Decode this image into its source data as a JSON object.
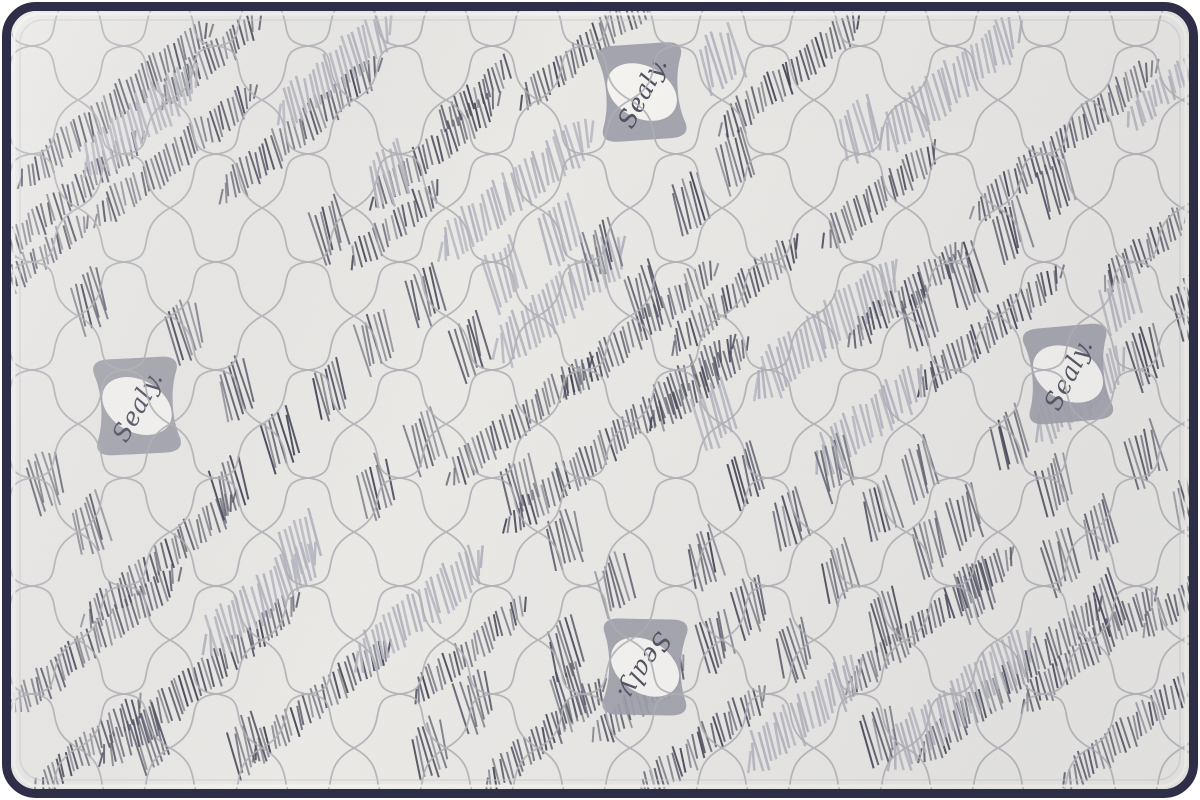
{
  "meta": {
    "description": "Top-down product photo of a quilted Sealy mattress with navy piped edge",
    "brand": "Sealy",
    "badge_label": "Sealy."
  },
  "colors": {
    "page_bg": "#ffffff",
    "fabric": "#ebeae7",
    "fabric_shade": "#8c8c96",
    "quilt_line": "#aeaeb4",
    "hatch_dark": [
      "#3f4052",
      "#4a4b5c",
      "#585a6a"
    ],
    "hatch_light": "#b5b6c1",
    "border": "#2e2e48",
    "piping_highlight": "#f4f4f1",
    "seam_shadow": "#c9c9cd",
    "badge_fill": "#9d9da9",
    "badge_oval": "#f6f5f2",
    "badge_text": "#4e4e5e"
  },
  "geometry": {
    "canvas_w": 1200,
    "canvas_h": 800,
    "border_width": 9,
    "corner_radius": 34,
    "band_angle_deg": -39,
    "lattice_tile_w": 92,
    "lattice_tile_h": 108
  },
  "badges": [
    {
      "x": 642,
      "y": 92,
      "rot": -4
    },
    {
      "x": 137,
      "y": 406,
      "rot": -3
    },
    {
      "x": 1068,
      "y": 374,
      "rot": -5
    },
    {
      "x": 645,
      "y": 667,
      "rot": 181
    }
  ],
  "bands": [
    [
      115,
      105,
      250,
      26,
      0
    ],
    [
      70,
      195,
      190,
      24,
      0
    ],
    [
      175,
      155,
      210,
      26,
      0
    ],
    [
      30,
      265,
      150,
      22,
      0
    ],
    [
      210,
      60,
      130,
      24,
      0
    ],
    [
      300,
      130,
      210,
      28,
      0
    ],
    [
      140,
      120,
      150,
      38,
      1
    ],
    [
      335,
      70,
      150,
      36,
      1
    ],
    [
      435,
      150,
      170,
      26,
      0
    ],
    [
      395,
      225,
      120,
      24,
      0
    ],
    [
      515,
      190,
      200,
      36,
      1
    ],
    [
      585,
      50,
      170,
      26,
      0
    ],
    [
      475,
      95,
      90,
      22,
      0
    ],
    [
      790,
      75,
      180,
      26,
      0
    ],
    [
      950,
      85,
      180,
      38,
      1
    ],
    [
      1065,
      140,
      240,
      26,
      0
    ],
    [
      880,
      195,
      150,
      26,
      0
    ],
    [
      1165,
      90,
      100,
      24,
      1
    ],
    [
      1145,
      250,
      110,
      24,
      0
    ],
    [
      640,
      330,
      200,
      26,
      0
    ],
    [
      560,
      300,
      170,
      40,
      1
    ],
    [
      735,
      295,
      170,
      26,
      0
    ],
    [
      825,
      330,
      190,
      40,
      1
    ],
    [
      905,
      295,
      150,
      24,
      0
    ],
    [
      990,
      330,
      190,
      26,
      0
    ],
    [
      520,
      420,
      190,
      26,
      0
    ],
    [
      620,
      435,
      300,
      28,
      0
    ],
    [
      700,
      385,
      130,
      24,
      0
    ],
    [
      870,
      420,
      140,
      36,
      1
    ],
    [
      1080,
      395,
      120,
      36,
      1
    ],
    [
      95,
      640,
      220,
      26,
      0
    ],
    [
      200,
      680,
      260,
      28,
      0
    ],
    [
      160,
      560,
      200,
      26,
      0
    ],
    [
      260,
      600,
      150,
      36,
      1
    ],
    [
      320,
      700,
      180,
      26,
      0
    ],
    [
      90,
      745,
      140,
      24,
      0
    ],
    [
      420,
      610,
      170,
      36,
      1
    ],
    [
      470,
      650,
      150,
      24,
      0
    ],
    [
      545,
      735,
      160,
      26,
      0
    ],
    [
      930,
      620,
      220,
      26,
      0
    ],
    [
      1010,
      680,
      240,
      28,
      0
    ],
    [
      960,
      700,
      190,
      40,
      1
    ],
    [
      1090,
      650,
      180,
      26,
      0
    ],
    [
      1130,
      730,
      170,
      26,
      0
    ],
    [
      1180,
      600,
      100,
      24,
      0
    ],
    [
      700,
      745,
      170,
      26,
      0
    ],
    [
      640,
      700,
      120,
      24,
      0
    ],
    [
      805,
      715,
      150,
      36,
      1
    ],
    [
      90,
      300,
      38,
      44,
      0
    ],
    [
      185,
      330,
      38,
      44,
      0
    ],
    [
      235,
      390,
      38,
      44,
      0
    ],
    [
      330,
      230,
      38,
      44,
      0
    ],
    [
      425,
      295,
      38,
      44,
      0
    ],
    [
      375,
      340,
      38,
      44,
      0
    ],
    [
      470,
      345,
      38,
      44,
      0
    ],
    [
      280,
      440,
      38,
      44,
      0
    ],
    [
      230,
      488,
      38,
      44,
      0
    ],
    [
      330,
      390,
      38,
      44,
      0
    ],
    [
      425,
      440,
      38,
      44,
      0
    ],
    [
      520,
      485,
      38,
      44,
      0
    ],
    [
      565,
      540,
      38,
      44,
      0
    ],
    [
      375,
      488,
      38,
      44,
      0
    ],
    [
      615,
      585,
      38,
      44,
      0
    ],
    [
      715,
      640,
      38,
      44,
      0
    ],
    [
      705,
      560,
      38,
      44,
      0
    ],
    [
      750,
      605,
      38,
      44,
      0
    ],
    [
      795,
      650,
      38,
      44,
      0
    ],
    [
      840,
      575,
      38,
      44,
      0
    ],
    [
      885,
      620,
      38,
      44,
      0
    ],
    [
      930,
      545,
      38,
      44,
      0
    ],
    [
      975,
      590,
      38,
      44,
      0
    ],
    [
      600,
      250,
      38,
      44,
      0
    ],
    [
      645,
      295,
      38,
      44,
      0
    ],
    [
      735,
      160,
      38,
      44,
      0
    ],
    [
      690,
      205,
      38,
      44,
      0
    ],
    [
      1010,
      230,
      38,
      44,
      0
    ],
    [
      965,
      275,
      38,
      44,
      0
    ],
    [
      920,
      320,
      38,
      44,
      0
    ],
    [
      1055,
      185,
      38,
      44,
      0
    ],
    [
      1190,
      310,
      38,
      44,
      0
    ],
    [
      1145,
      355,
      38,
      44,
      0
    ],
    [
      45,
      480,
      38,
      44,
      0
    ],
    [
      90,
      525,
      38,
      44,
      0
    ],
    [
      150,
      740,
      38,
      44,
      0
    ],
    [
      245,
      745,
      38,
      44,
      0
    ],
    [
      430,
      750,
      38,
      44,
      0
    ],
    [
      475,
      700,
      38,
      44,
      0
    ],
    [
      565,
      650,
      38,
      44,
      0
    ],
    [
      570,
      695,
      38,
      44,
      0
    ],
    [
      880,
      735,
      38,
      44,
      0
    ],
    [
      1060,
      560,
      38,
      44,
      0
    ],
    [
      1105,
      605,
      38,
      44,
      0
    ],
    [
      745,
      475,
      38,
      44,
      0
    ],
    [
      790,
      520,
      38,
      44,
      0
    ],
    [
      835,
      465,
      38,
      44,
      0
    ],
    [
      880,
      510,
      38,
      44,
      0
    ],
    [
      920,
      470,
      38,
      44,
      0
    ],
    [
      965,
      515,
      38,
      44,
      0
    ],
    [
      1010,
      440,
      38,
      44,
      0
    ],
    [
      1055,
      485,
      38,
      44,
      0
    ],
    [
      1100,
      530,
      38,
      44,
      0
    ],
    [
      1145,
      455,
      38,
      44,
      0
    ],
    [
      1190,
      500,
      38,
      44,
      0
    ],
    [
      560,
      230,
      44,
      46,
      1
    ],
    [
      505,
      275,
      44,
      46,
      1
    ],
    [
      390,
      175,
      44,
      46,
      1
    ],
    [
      860,
      130,
      44,
      46,
      1
    ],
    [
      715,
      415,
      44,
      46,
      1
    ],
    [
      1120,
      300,
      44,
      46,
      1
    ],
    [
      300,
      545,
      44,
      46,
      1
    ],
    [
      720,
      60,
      44,
      46,
      1
    ]
  ]
}
